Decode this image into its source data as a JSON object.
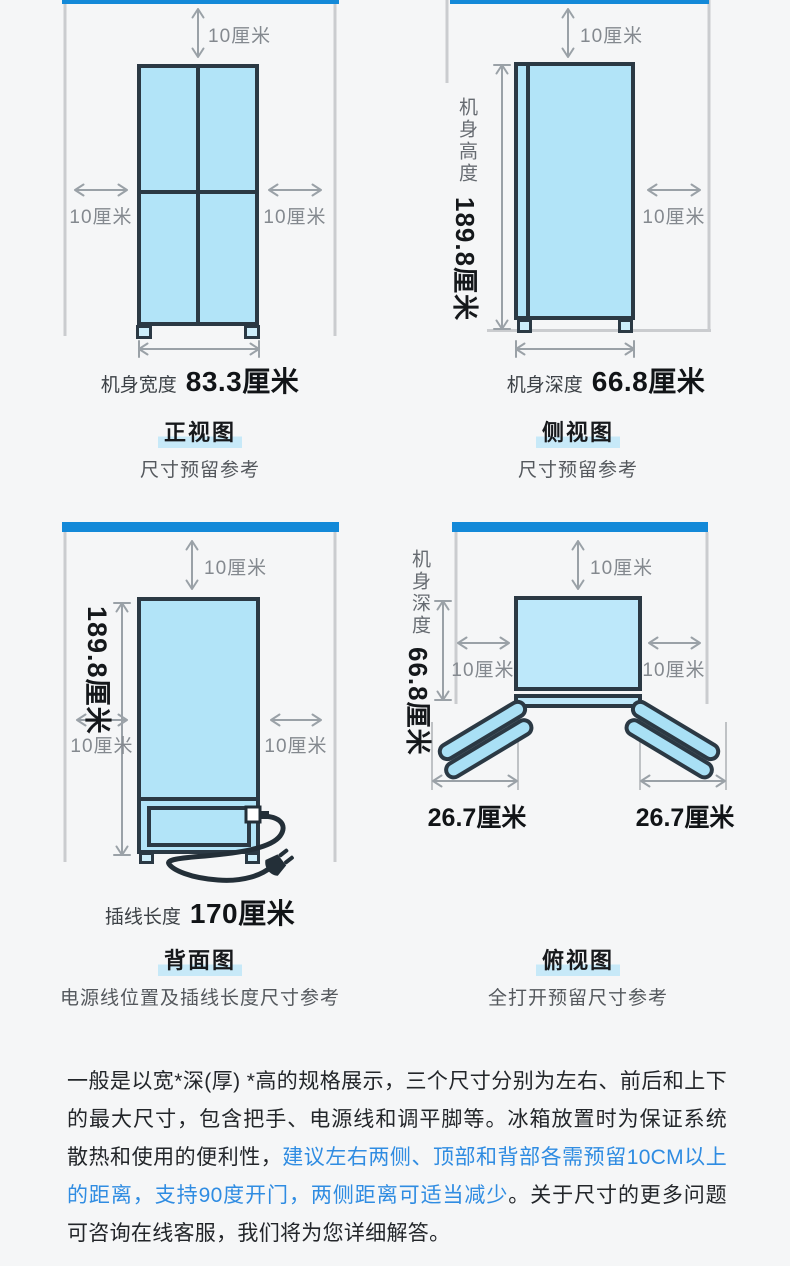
{
  "page": {
    "background": "#f5f6f7",
    "accent_blue": "#1389d8",
    "fridge_fill": "#b2e4f8",
    "outline_color": "#2b3944",
    "highlight_text_blue": "#2f8ce2"
  },
  "front_view": {
    "clearance_top": "10厘米",
    "clearance_left": "10厘米",
    "clearance_right": "10厘米",
    "dim_label": "机身宽度",
    "dim_value": "83.3厘米",
    "title": "正视图",
    "subtitle": "尺寸预留参考"
  },
  "side_view": {
    "clearance_top": "10厘米",
    "clearance_right": "10厘米",
    "height_label": "机身高度",
    "height_value": "189.8厘米",
    "dim_label": "机身深度",
    "dim_value": "66.8厘米",
    "title": "侧视图",
    "subtitle": "尺寸预留参考"
  },
  "back_view": {
    "clearance_top": "10厘米",
    "clearance_left": "10厘米",
    "clearance_right": "10厘米",
    "height_value": "189.8厘米",
    "cord_label": "插线长度",
    "cord_value": "170厘米",
    "title": "背面图",
    "subtitle": "电源线位置及插线长度尺寸参考"
  },
  "top_view": {
    "clearance_top": "10厘米",
    "clearance_left": "10厘米",
    "clearance_right": "10厘米",
    "depth_label": "机身深度",
    "depth_value": "66.8厘米",
    "door_swing_left": "26.7厘米",
    "door_swing_right": "26.7厘米",
    "title": "俯视图",
    "subtitle": "全打开预留尺寸参考"
  },
  "note": {
    "text_before": "一般是以宽*深(厚) *高的规格展示，三个尺寸分别为左右、前后和上下的最大尺寸，包含把手、电源线和调平脚等。冰箱放置时为保证系统散热和使用的便利性，",
    "text_highlight": "建议左右两侧、顶部和背部各需预留10CM以上的距离，支持90度开门，两侧距离可适当减少",
    "text_after": "。关于尺寸的更多问题可咨询在线客服，我们将为您详细解答。"
  }
}
